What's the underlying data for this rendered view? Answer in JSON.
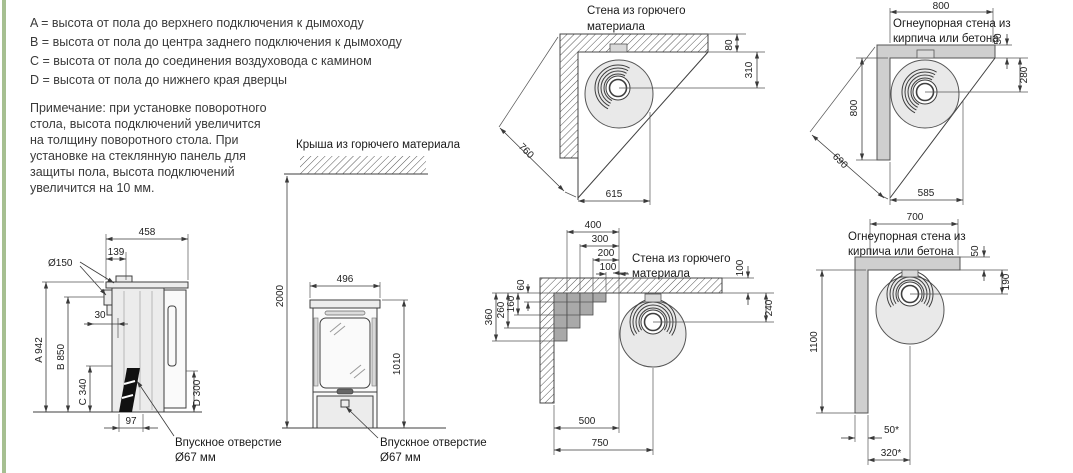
{
  "legend": {
    "lines": [
      "A = высота от пола до верхнего подключения к дымоходу",
      "B = высота от пола до центра заднего подключения к дымоходу",
      "C = высота от пола до соединения воздуховода с камином",
      "D = высота от пола до нижнего края дверцы"
    ]
  },
  "note": {
    "lines": [
      "Примечание: при установке поворотного",
      "стола, высота подключений увеличится",
      "на толщину поворотного стола.  При",
      "установке на стеклянную панель для",
      "защиты пола, высота подключений",
      "увеличится на 10 мм."
    ]
  },
  "side_view": {
    "dim_458": "458",
    "dim_139": "139",
    "flue_diameter": "Ø150",
    "dim_30": "30",
    "dim_a": "A 942",
    "dim_b": "B 850",
    "dim_c": "C 340",
    "dim_d": "D 300",
    "dim_97": "97",
    "inlet_line1": "Впускное отверстие",
    "inlet_line2": "Ø67 мм"
  },
  "front_view": {
    "roof_label": "Крыша из горючего материала",
    "dim_2000": "2000",
    "dim_496": "496",
    "dim_1010": "1010",
    "inlet_line1": "Впускное отверстие",
    "inlet_line2": "Ø67 мм"
  },
  "corner_combustible": {
    "wall_label_line1": "Стена из горючего",
    "wall_label_line2": "материала",
    "dim_80": "80",
    "dim_310": "310",
    "dim_760": "760",
    "dim_615": "615"
  },
  "corner_firebrick_top": {
    "wall_label_line1": "Огнеупорная стена из",
    "wall_label_line2": "кирпича или бетона",
    "dim_800_top": "800",
    "dim_50": "50",
    "dim_280": "280",
    "dim_800_left": "800",
    "dim_690": "690",
    "dim_585": "585"
  },
  "stepped_wall": {
    "wall_label_line1": "Стена из горючего",
    "wall_label_line2": "материала",
    "dim_400": "400",
    "dim_300": "300",
    "dim_200": "200",
    "dim_100_top": "100",
    "dim_60": "60",
    "dim_160": "160",
    "dim_260": "260",
    "dim_360": "360",
    "dim_100_right": "100",
    "dim_240": "240",
    "dim_500": "500",
    "dim_750": "750"
  },
  "corner_firebrick_bottom": {
    "wall_label_line1": "Огнеупорная стена из",
    "wall_label_line2": "кирпича или бетона",
    "dim_700": "700",
    "dim_50": "50",
    "dim_190": "190",
    "dim_1100": "1100",
    "dim_50_star": "50*",
    "dim_320_star": "320*"
  }
}
